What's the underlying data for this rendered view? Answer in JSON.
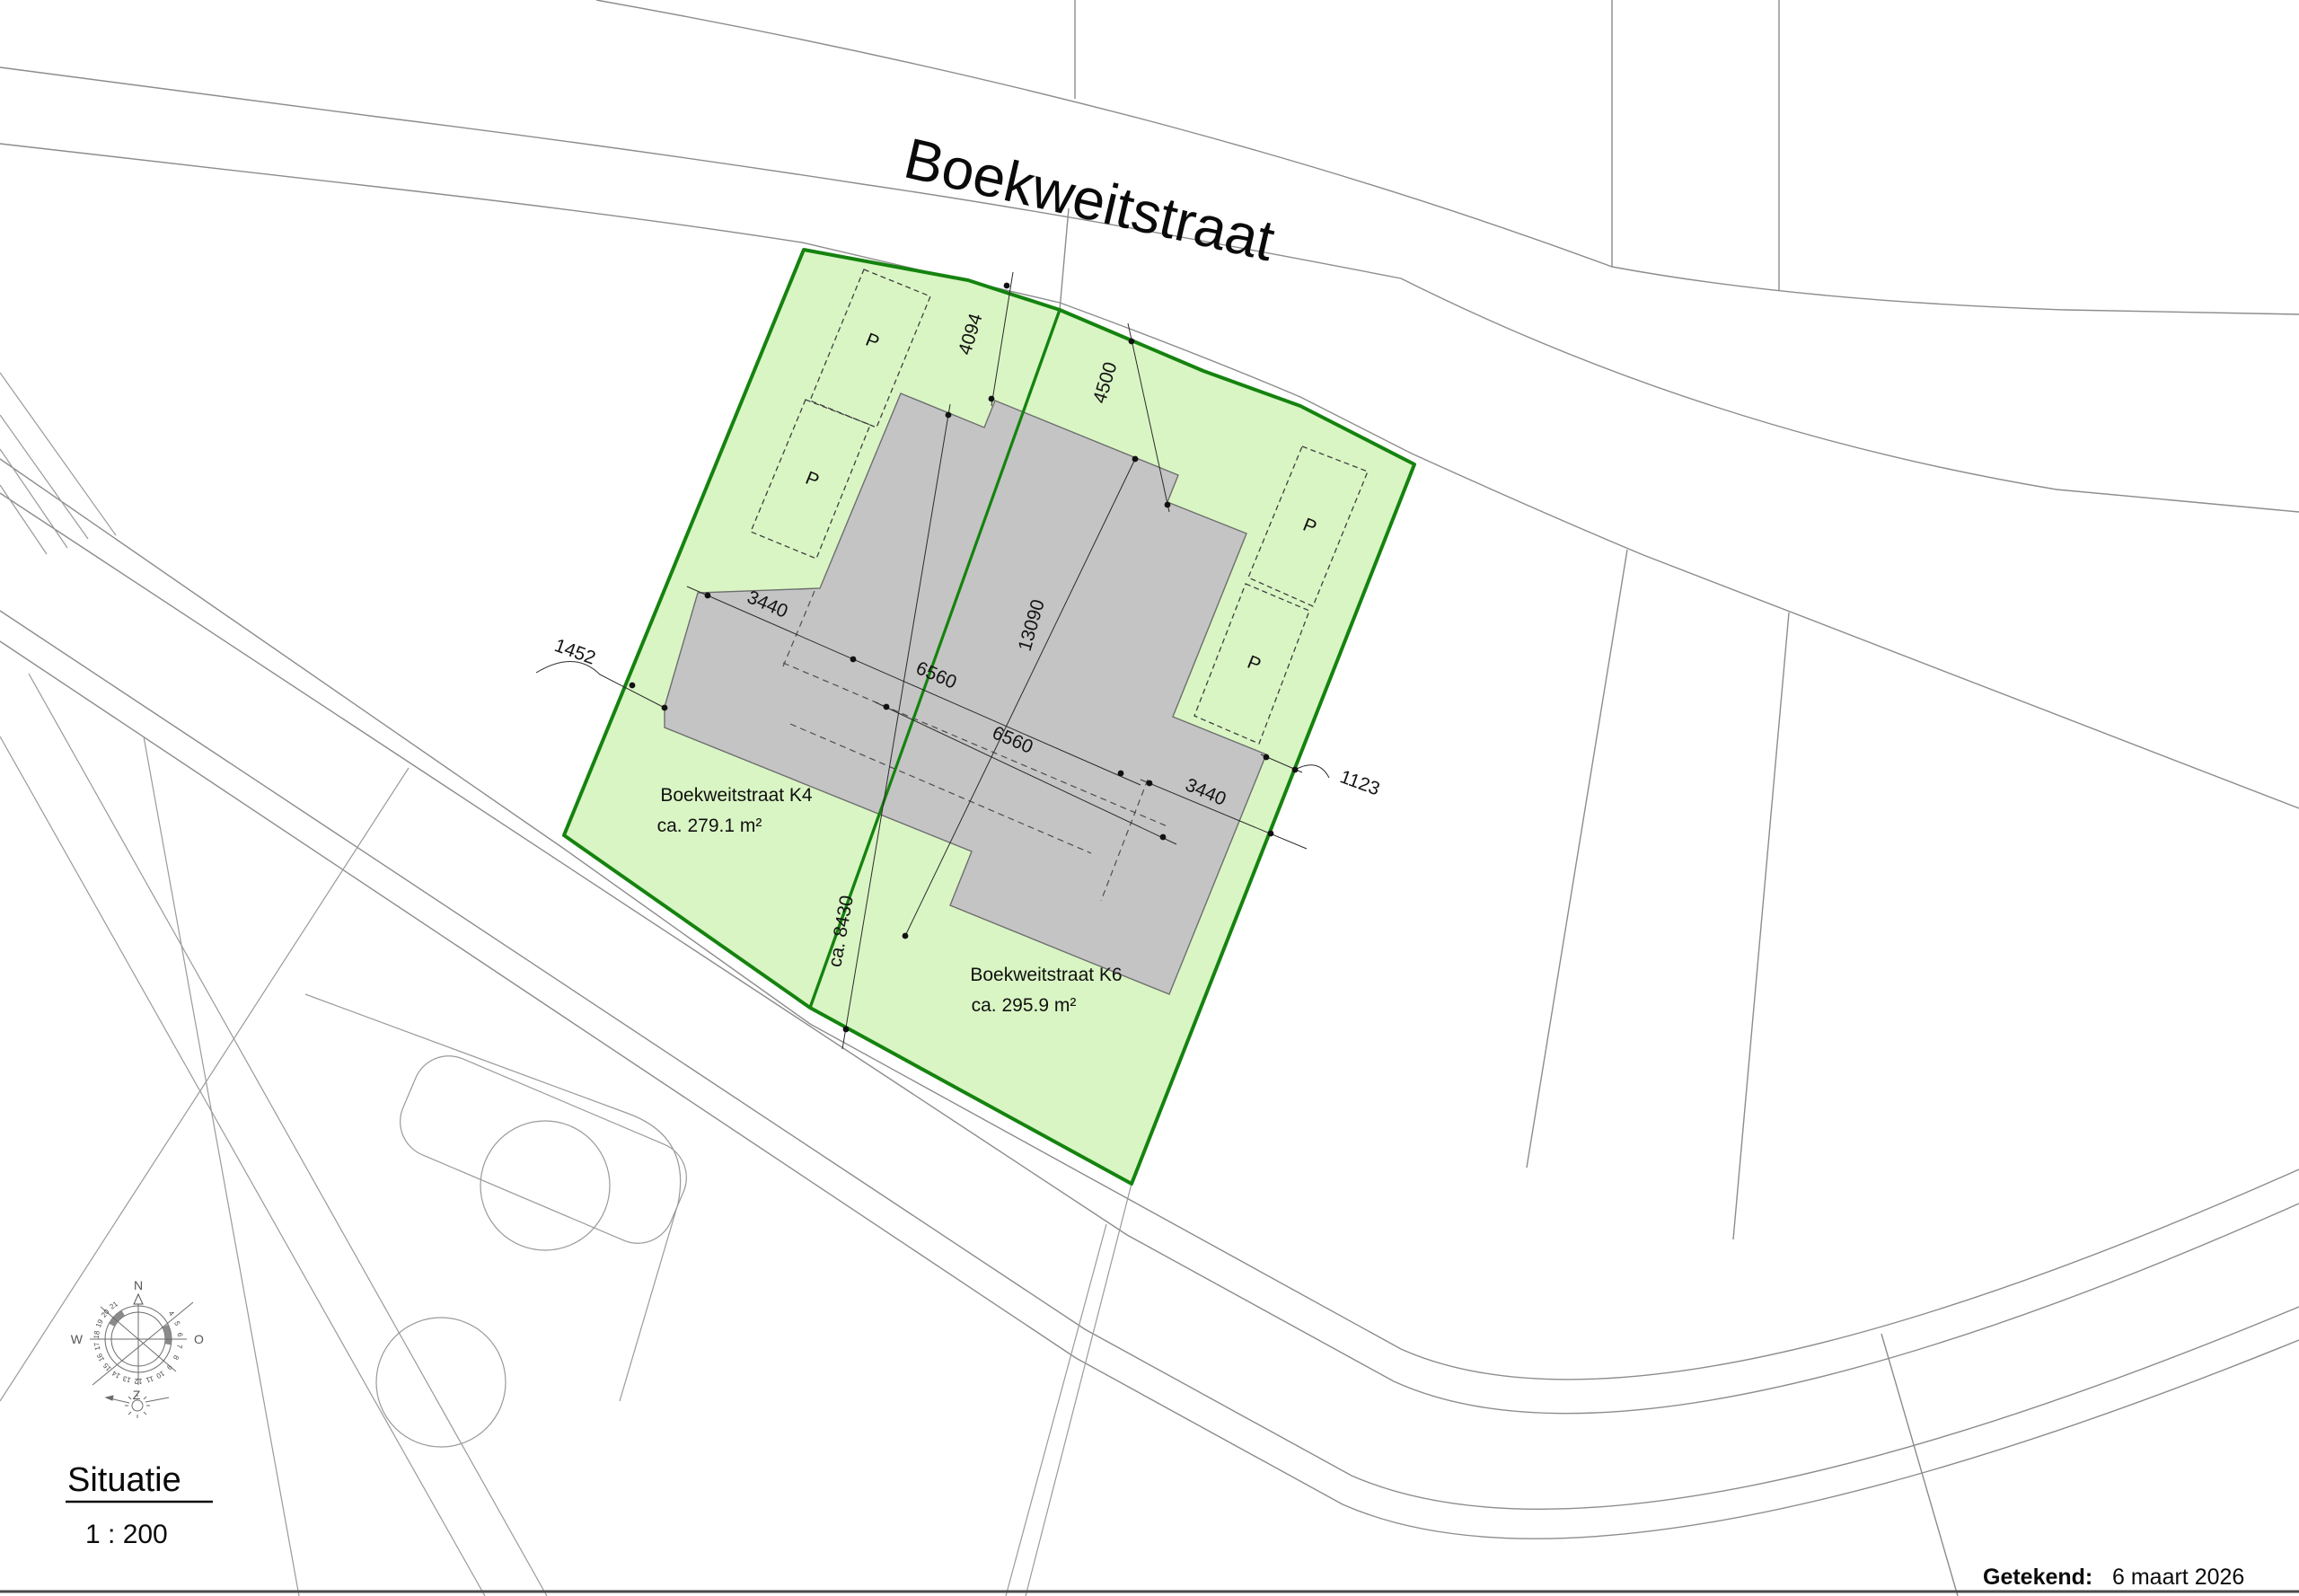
{
  "street": {
    "name": "Boekweitstraat"
  },
  "plots": [
    {
      "id": "K4",
      "label": "Boekweitstraat K4",
      "area": "ca. 279.1 m²"
    },
    {
      "id": "K6",
      "label": "Boekweitstraat K6",
      "area": "ca. 295.9 m²"
    }
  ],
  "parking": {
    "label": "P"
  },
  "dimensions": {
    "front_left": "4094",
    "front_right": "4500",
    "left_ext_width": "3440",
    "left_house_width": "6560",
    "house_depth": "13090",
    "right_house_width": "6560",
    "right_ext_width": "3440",
    "west_offset": "1452",
    "east_offset": "1123",
    "k6_depth": "ca. 8430"
  },
  "compass": {
    "north": "N",
    "east": "O",
    "south": "Z",
    "west": "W",
    "hours": [
      "4",
      "5",
      "6",
      "7",
      "8",
      "9",
      "10",
      "11",
      "12",
      "13",
      "14",
      "15",
      "16",
      "17",
      "18",
      "19",
      "20",
      "21"
    ]
  },
  "title": {
    "text": "Situatie",
    "scale": "1 : 200"
  },
  "footer": {
    "label": "Getekend:",
    "date": "6 maart 2026"
  },
  "colors": {
    "plot_fill": "#d9f5c4",
    "plot_border": "#15830f",
    "building_fill": "#c4c4c4",
    "context_line": "#8c8c8c"
  }
}
